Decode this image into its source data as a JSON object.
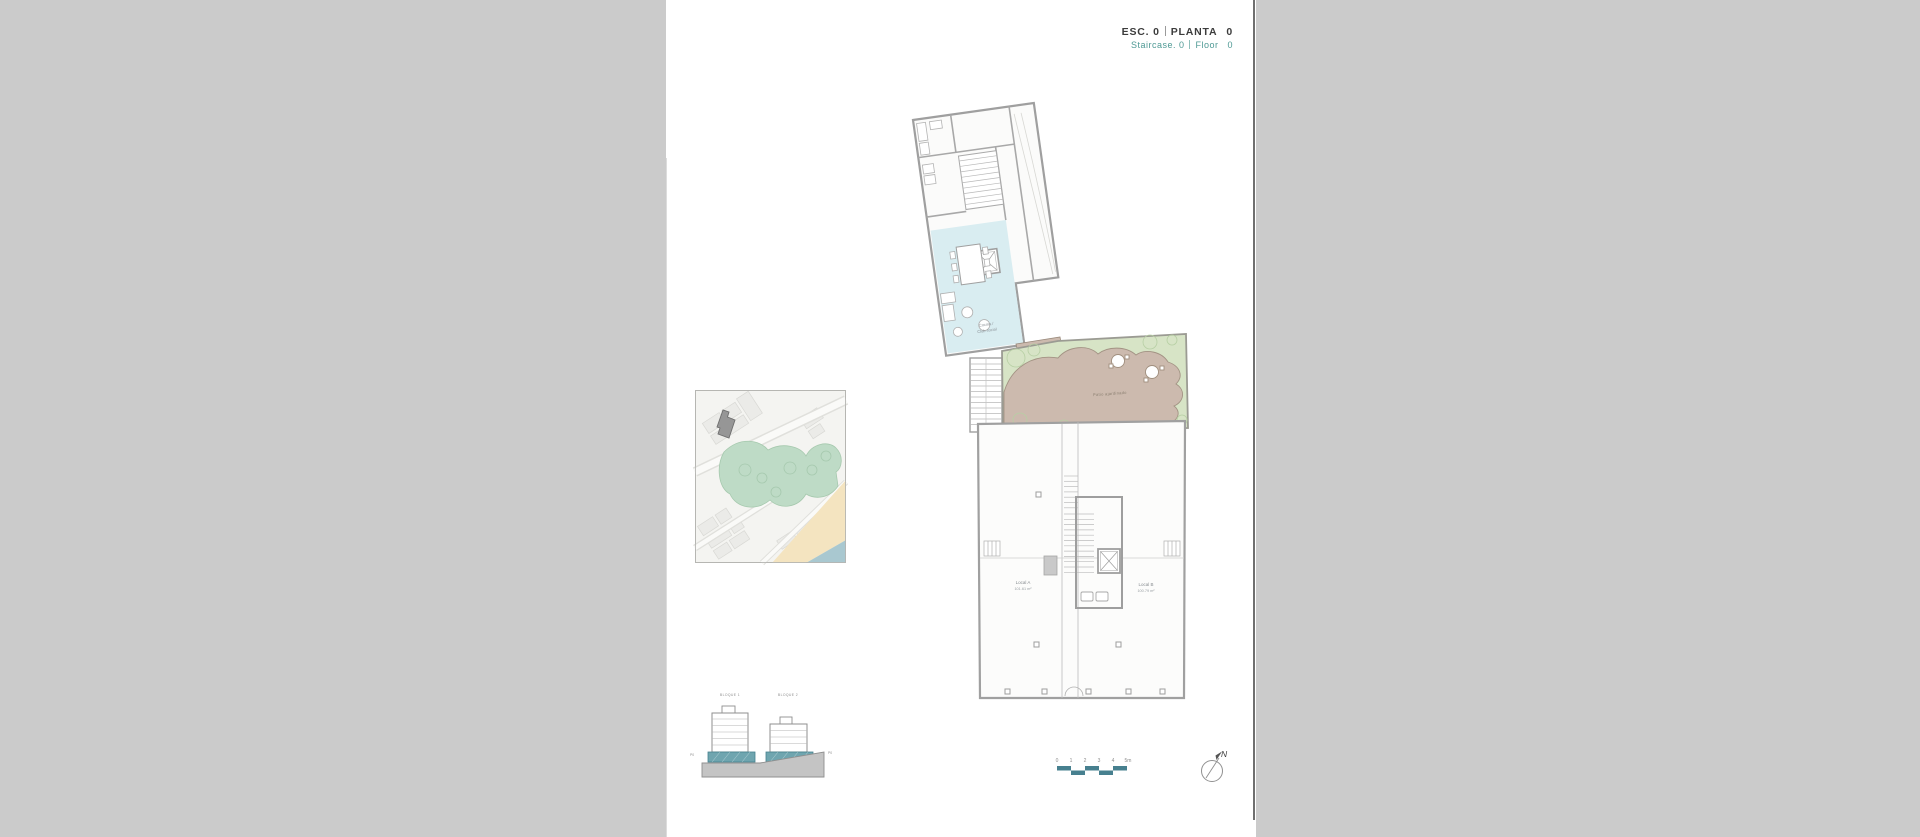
{
  "colors": {
    "margin_gray": "#cbcbcb",
    "accent_teal": "#47808f",
    "header_teal": "#4f9a95",
    "header_dark": "#3c3c3c",
    "wall_gray": "#a0a0a0",
    "cyan_room": "#d9edf1",
    "terrace_tan": "#ccbaae",
    "garden_green": "#d7e4c6",
    "map_green": "#bedbc6",
    "map_sand": "#f4e4c0",
    "map_sea": "#a9c8d0",
    "footprint_gray": "#969696"
  },
  "header": {
    "esc": "ESC. 0",
    "planta": "PLANTA",
    "planta_value": "0",
    "staircase": "Staircase. 0",
    "floor": "Floor",
    "floor_value": "0"
  },
  "plan": {
    "club_line1": "Cocina /",
    "club_line2": "Club social",
    "passage_label": "Zona común",
    "patio_label": "Patio ajardinado",
    "local_a": {
      "name": "Local A",
      "area": "101.61 m²"
    },
    "local_b": {
      "name": "Local B",
      "area": "100.79 m²"
    }
  },
  "section": {
    "block1": "BLOQUE 1",
    "block2": "BLOQUE 2",
    "level_left": "P0",
    "level_right": "P0"
  },
  "scalebar": {
    "ticks": [
      "0",
      "1",
      "2",
      "3",
      "4",
      "5m"
    ]
  },
  "north": {
    "label": "N"
  }
}
